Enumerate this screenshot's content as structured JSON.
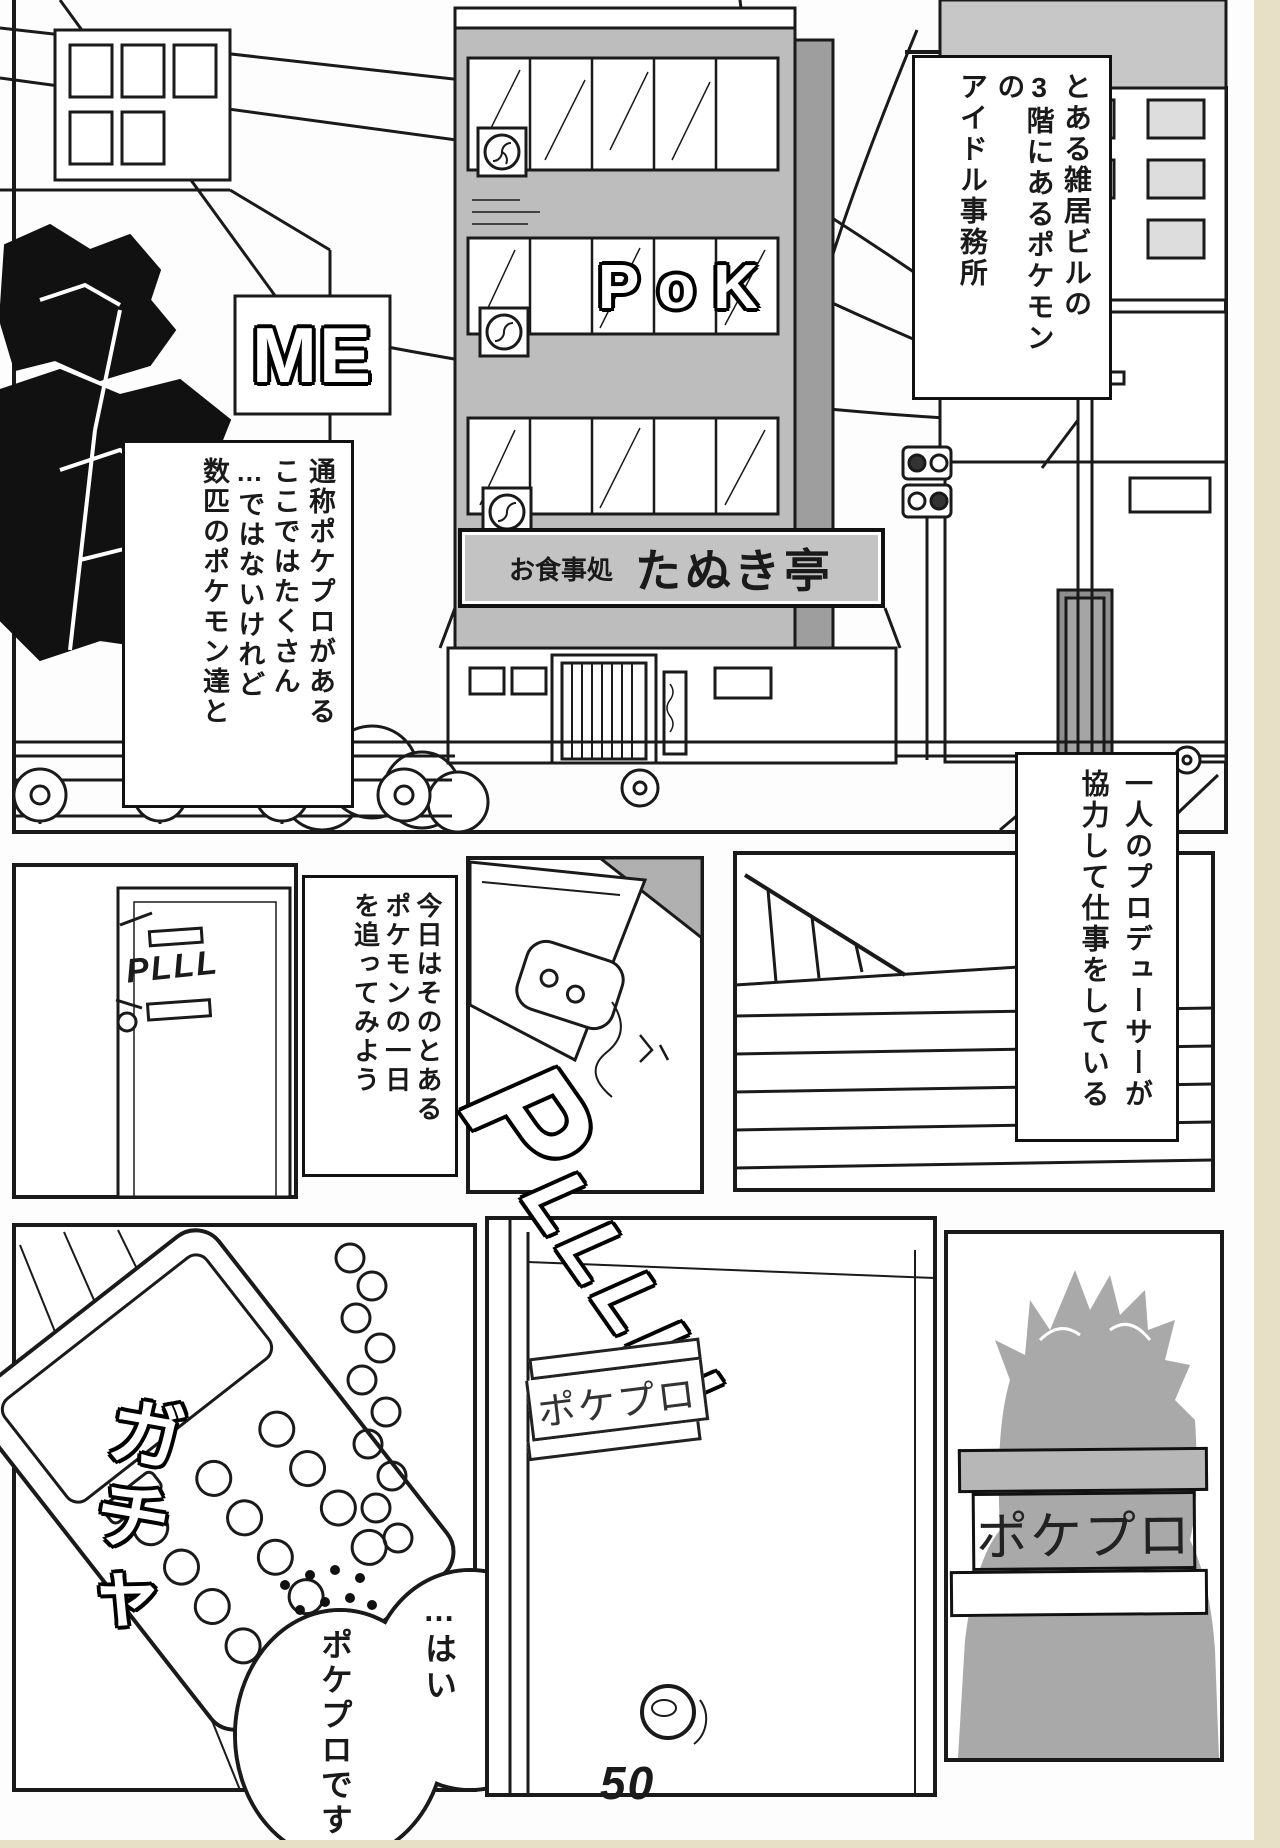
{
  "page_number": "50",
  "colors": {
    "ink": "#1a1a1a",
    "building_facade_gray": "#bdbdbd",
    "building_side_gray": "#9e9e9e",
    "sign_gray": "#c3c3c3",
    "silhouette_gray": "#a9a9a9",
    "scan_edge_cream": "#e7dfc6"
  },
  "street_panel": {
    "caption_intro": {
      "line1": "とある雑居ビルの",
      "line2": "3階にあるポケモンの",
      "line3": "アイドル事務所"
    },
    "caption_pokepro": {
      "line1": "通称ポケプロがある",
      "line2": "ここではたくさん",
      "line3": "…ではないけれど",
      "line4": "数匹のポケモン達と"
    },
    "restaurant_sign": {
      "prefix": "お食事処",
      "name": "たぬき亭"
    },
    "window_letters": "PoK",
    "background_sign_letters": "ME"
  },
  "door_panel": {
    "sfx_ring_small": "PLLL"
  },
  "caption_today": {
    "line1": "今日はそのとある",
    "line2": "ポケモンの一日",
    "line3": "を追ってみよう"
  },
  "caption_producer": {
    "line1": "一人のプロデューサーが",
    "line2": "協力して仕事をしている"
  },
  "office_panel": {
    "sfx_ring_large": "PLLLLL"
  },
  "phone_panel": {
    "sfx_pickup": "ガチャ",
    "speech_bubble": {
      "line1": "…はい",
      "line2": "ポケプロです"
    }
  },
  "office_door_panel": {
    "door_sign": "ポケプロ"
  },
  "silhouette_panel": {
    "sign": "ポケプロ"
  }
}
